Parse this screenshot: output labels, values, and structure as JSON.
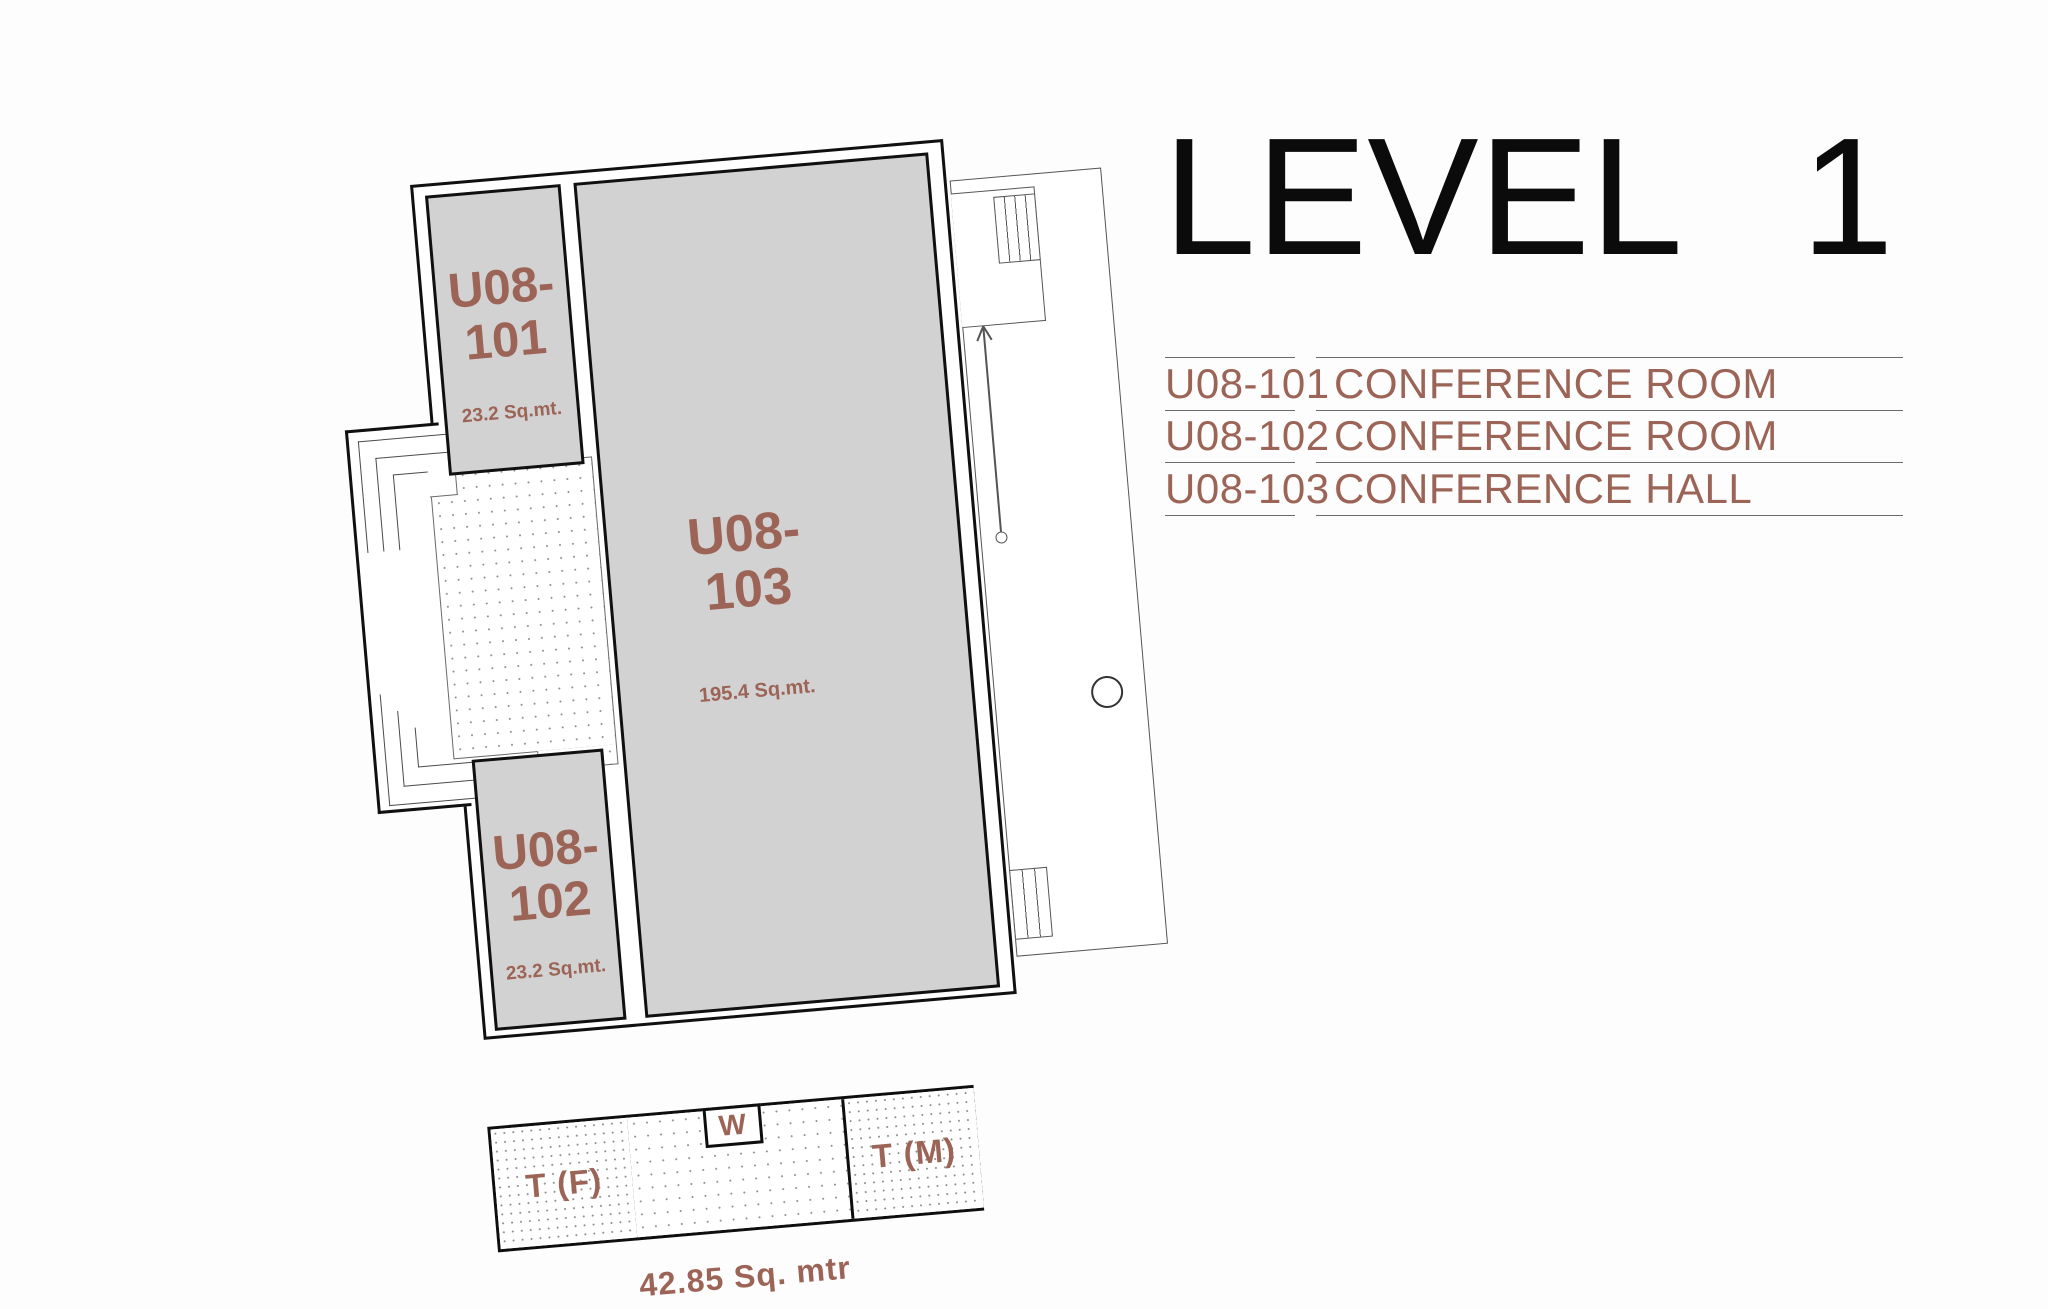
{
  "header": {
    "title_word": "LEVEL",
    "title_number": "1"
  },
  "legend": {
    "rows": [
      {
        "code": "U08-101",
        "name": "CONFERENCE ROOM"
      },
      {
        "code": "U08-102",
        "name": "CONFERENCE ROOM"
      },
      {
        "code": "U08-103",
        "name": "CONFERENCE HALL"
      }
    ]
  },
  "plan": {
    "rooms": [
      {
        "id": "U08-101",
        "code_line1": "U08-",
        "code_line2": "101",
        "area": "23.2 Sq.mt."
      },
      {
        "id": "U08-102",
        "code_line1": "U08-",
        "code_line2": "102",
        "area": "23.2 Sq.mt."
      },
      {
        "id": "U08-103",
        "code_line1": "U08-",
        "code_line2": "103",
        "area": "195.4 Sq.mt."
      }
    ],
    "toilet_block": {
      "female_label": "T (F)",
      "water_closet_label": "W",
      "male_label": "T (M)",
      "area_caption": "42.85 Sq. mtr"
    }
  },
  "colors": {
    "accent": "#9C6456",
    "room_fill": "#D2D2D2",
    "outline": "#101010",
    "thin_line": "#555555",
    "legend_rule": "#6B6B6B"
  }
}
